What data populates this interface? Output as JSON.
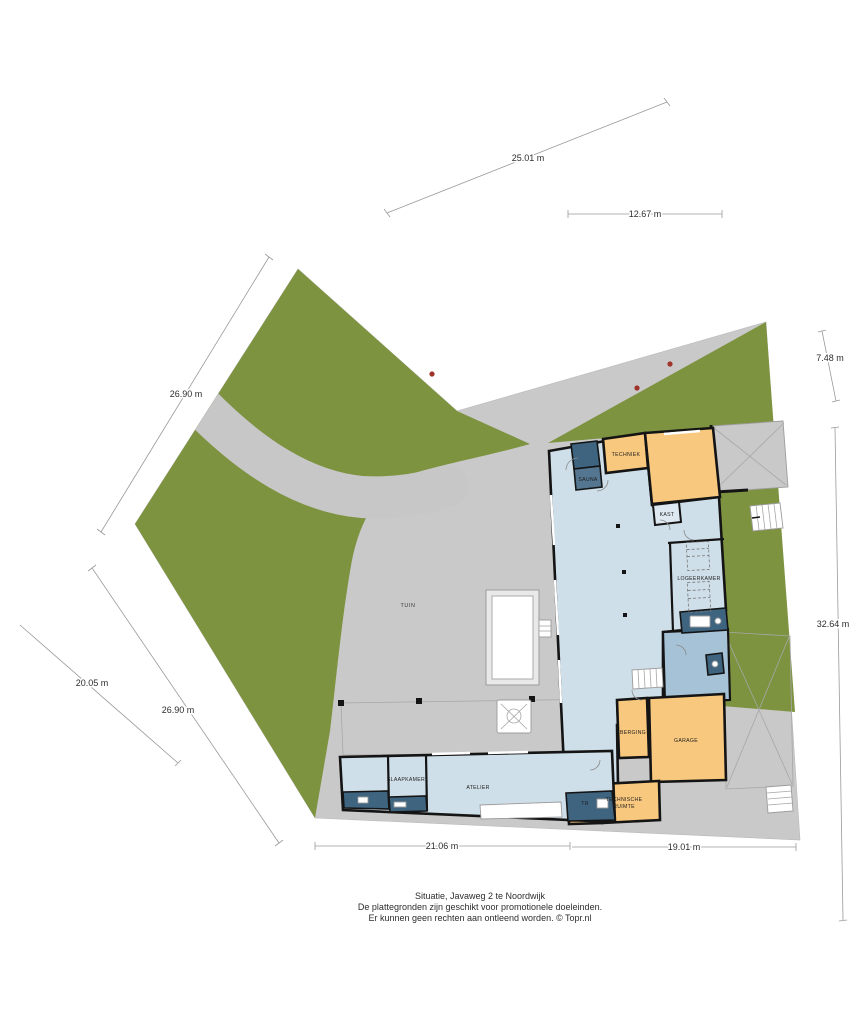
{
  "caption": {
    "line1": "Situatie, Javaweg 2 te Noordwijk",
    "line2": "De plattegronden zijn geschikt voor promotionele doeleinden.",
    "line3": "Er kunnen geen rechten aan ontleend worden. © Topr.nl"
  },
  "labels": {
    "tuin": "TUIN",
    "sauna": "SAUNA",
    "techniek": "TECHNIEK",
    "kast": "KAST",
    "logeerkamer": "LOGEERKAMER",
    "berging": "BERGING",
    "garage": "GARAGE",
    "tr": "TR",
    "technische_1": "TECHNISCHE",
    "technische_2": "RUIMTE",
    "slaapkamer": "SLAAPKAMER",
    "atelier": "ATELIER"
  },
  "dimensions": {
    "top_diag": "25.01 m",
    "top_h": "12.67 m",
    "right_short": "7.48 m",
    "right_long": "32.64 m",
    "left_upper": "26.90 m",
    "left_lower_a": "20.05 m",
    "left_lower_b": "26.90 m",
    "bottom_a": "21.06 m",
    "bottom_b": "19.01 m"
  },
  "colors": {
    "green": "#7e9340",
    "paving": "#c9c9c9",
    "path": "#c7c7c7",
    "room_light": "#cfdfe9",
    "room_medium": "#a5c2d6",
    "room_dark": "#3e6480",
    "room_orange": "#f8c87e",
    "wall": "#141414",
    "marker": "#a0342b",
    "dim": "#9a9a9a"
  }
}
